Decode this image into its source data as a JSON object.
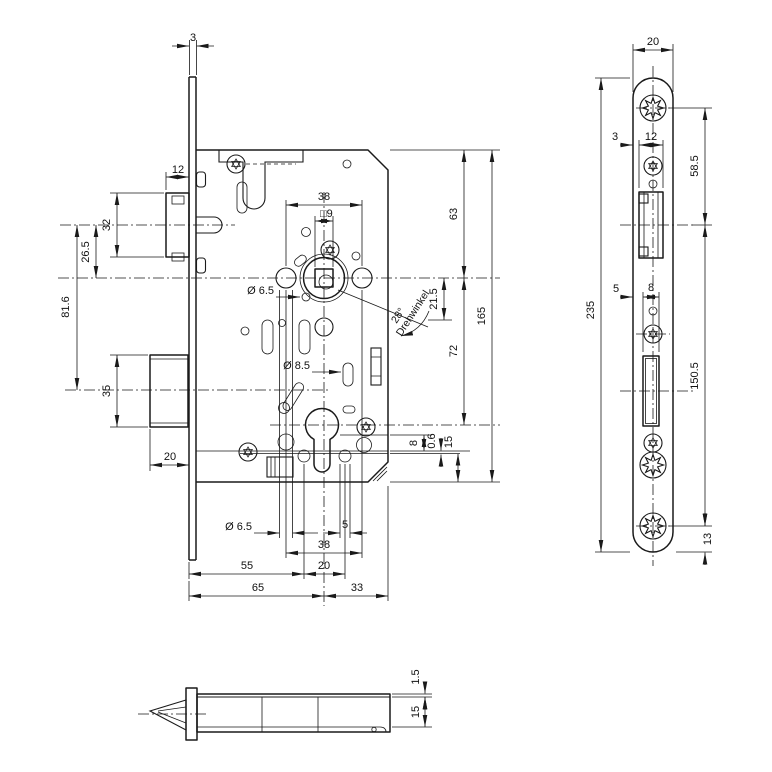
{
  "front": {
    "faceplate_thickness": "3",
    "latch_width": "12",
    "latch_height": "32",
    "latch_to_follower": "26.5",
    "latch_to_bolt": "81.6",
    "bolt_height": "35",
    "bolt_throw": "20",
    "handle_hole_spacing": "38",
    "spindle_square": "□9",
    "handle_hole_dia": "Ø 6.5",
    "cylinder_screw_dia": "Ø 8.5",
    "rotation_angle": "28°",
    "rotation_angle_label": "Drehwinkel",
    "rotation_offset": "21.5",
    "top_to_follower": "63",
    "case_length": "165",
    "follower_to_cylinder": "72",
    "edge_8": "8",
    "cover_gap": "0.6",
    "edge_15": "15",
    "bottom_hole_dia": "Ø 6.5",
    "bottom_hole_5": "5",
    "bottom_spacing_38": "38",
    "bottom_spacing_20": "20",
    "backset_to_hole": "55",
    "backset": "65",
    "case_rear": "33"
  },
  "faceplate": {
    "width": "20",
    "latch_cut_offset": "3",
    "latch_cut_width": "12",
    "screw_to_latch_axis": "58.5",
    "bolt_cut_offset": "5",
    "bolt_cut_width": "8",
    "length": "235",
    "latch_axis_to_screw": "150.5",
    "screw_to_end": "13"
  },
  "side": {
    "cover_thickness": "1.5",
    "case_depth": "15"
  }
}
